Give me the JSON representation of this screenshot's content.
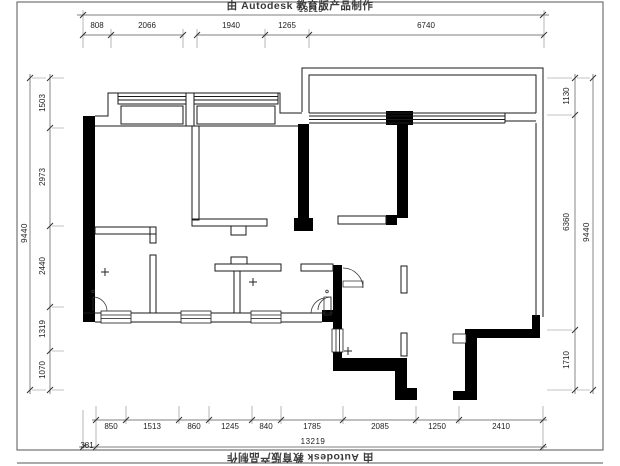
{
  "sheet": {
    "watermark_top": "由 Autodesk 教育版产品制作",
    "watermark_bottom": "由 Autodesk 教育版产品制作"
  },
  "dimensions": {
    "top": {
      "total": "13219",
      "segments": [
        "808",
        "2066",
        "1940",
        "1265",
        "6740"
      ]
    },
    "bottom": {
      "total": "13219",
      "offset": "381",
      "segments": [
        "850",
        "1513",
        "860",
        "1245",
        "840",
        "1785",
        "2085",
        "1250",
        "2410"
      ]
    },
    "left": {
      "total": "9440",
      "segments": [
        "1503",
        "2973",
        "2440",
        "1319",
        "1070"
      ]
    },
    "right": {
      "total": "9440",
      "segments": [
        "1130",
        "6360",
        "1710"
      ]
    }
  }
}
